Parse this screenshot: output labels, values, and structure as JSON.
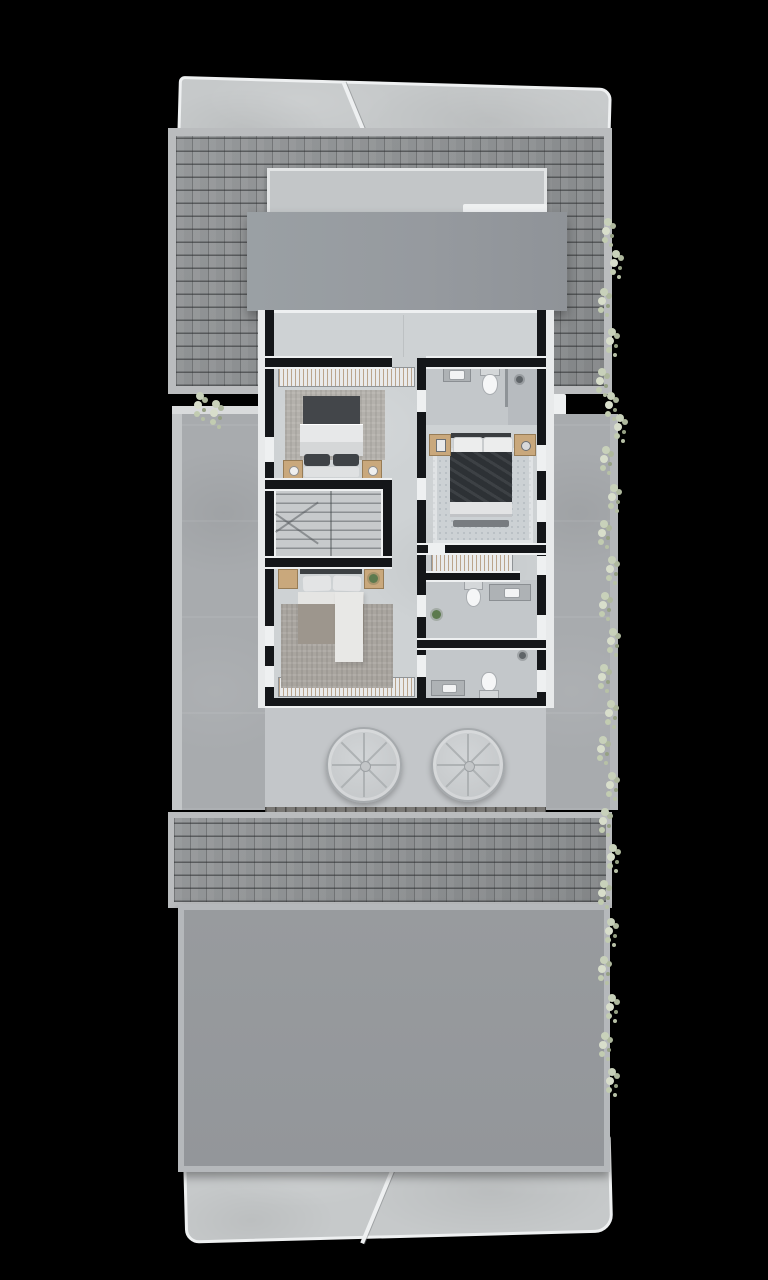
{
  "meta": {
    "description": "Top-down 3D architectural render of an upper-storey residential floor plan on a black background"
  },
  "palette": {
    "background": "#000000",
    "wall": "#141619",
    "trim": "#eef0f1",
    "floor": "#ced2d4",
    "floor_bath": "#c3c7ca",
    "roof_shingle": "#8e9193",
    "roof_fascia": "#babcbe",
    "concrete": "#c6c9ca",
    "concrete_side": "#a8abae",
    "flat_roof": "#979b9f",
    "flat_roof_2": "#95989c",
    "wood": "#c9a87c",
    "duvet_dark": "#2d3135",
    "duvet_white": "#e7e8e9",
    "duvet_taupe": "#9d968d",
    "pillow_dark": "#3f4347",
    "rug_a": "#b4b1ac",
    "rug_b": "#a9a59f",
    "rug_c": "#ccd1d4",
    "plant": "#5d7a4e",
    "veg": "#c8d1ba",
    "stair": "#c7cacc"
  },
  "plan": {
    "rooms": [
      {
        "name": "hallway",
        "furniture": []
      },
      {
        "name": "bedroom-1",
        "furniture": [
          "wardrobe",
          "rug",
          "double-bed",
          "nightstand",
          "nightstand"
        ]
      },
      {
        "name": "stairs",
        "furniture": [
          "staircase"
        ]
      },
      {
        "name": "bedroom-2",
        "furniture": [
          "double-bed",
          "nightstand",
          "nightstand",
          "plant",
          "rug",
          "wardrobe"
        ]
      },
      {
        "name": "bathroom-1",
        "furniture": [
          "sink",
          "toilet",
          "shower"
        ]
      },
      {
        "name": "bedroom-3",
        "furniture": [
          "double-bed",
          "nightstand",
          "nightstand",
          "rug",
          "bench"
        ]
      },
      {
        "name": "closet",
        "furniture": [
          "wardrobe"
        ]
      },
      {
        "name": "bathroom-2",
        "furniture": [
          "toilet",
          "sink",
          "plant"
        ]
      },
      {
        "name": "bathroom-3",
        "furniture": [
          "sink",
          "toilet",
          "shower"
        ]
      }
    ],
    "openings": {
      "left_wall": [
        {
          "y": 127,
          "h": 25,
          "type": "window"
        },
        {
          "y": 316,
          "h": 20,
          "type": "window"
        },
        {
          "y": 356,
          "h": 21,
          "type": "door"
        }
      ],
      "right_wall": [
        {
          "y": 135,
          "h": 26,
          "type": "window"
        },
        {
          "y": 190,
          "h": 22,
          "type": "window"
        },
        {
          "y": 246,
          "h": 19,
          "type": "window"
        },
        {
          "y": 305,
          "h": 23,
          "type": "window"
        },
        {
          "y": 360,
          "h": 22,
          "type": "door"
        }
      ],
      "divider": [
        {
          "y": 80,
          "h": 22,
          "type": "door"
        },
        {
          "y": 168,
          "h": 22,
          "type": "door"
        },
        {
          "y": 285,
          "h": 22,
          "type": "door"
        },
        {
          "y": 345,
          "h": 22,
          "type": "door"
        }
      ]
    }
  },
  "decor": {
    "fans": [
      {
        "x": 362,
        "y": 763,
        "r": 36
      },
      {
        "x": 466,
        "y": 763,
        "r": 35
      }
    ],
    "vegetation": [
      {
        "x": 604,
        "y": 218
      },
      {
        "x": 612,
        "y": 250
      },
      {
        "x": 600,
        "y": 288
      },
      {
        "x": 608,
        "y": 328
      },
      {
        "x": 598,
        "y": 368
      },
      {
        "x": 607,
        "y": 392
      },
      {
        "x": 616,
        "y": 414
      },
      {
        "x": 602,
        "y": 446
      },
      {
        "x": 610,
        "y": 484
      },
      {
        "x": 600,
        "y": 520
      },
      {
        "x": 608,
        "y": 556
      },
      {
        "x": 601,
        "y": 592
      },
      {
        "x": 609,
        "y": 628
      },
      {
        "x": 600,
        "y": 664
      },
      {
        "x": 607,
        "y": 700
      },
      {
        "x": 599,
        "y": 736
      },
      {
        "x": 608,
        "y": 772
      },
      {
        "x": 601,
        "y": 808
      },
      {
        "x": 609,
        "y": 844
      },
      {
        "x": 600,
        "y": 880
      },
      {
        "x": 607,
        "y": 918
      },
      {
        "x": 600,
        "y": 956
      },
      {
        "x": 608,
        "y": 994
      },
      {
        "x": 601,
        "y": 1032
      },
      {
        "x": 608,
        "y": 1068
      },
      {
        "x": 196,
        "y": 392
      },
      {
        "x": 212,
        "y": 400
      }
    ]
  }
}
